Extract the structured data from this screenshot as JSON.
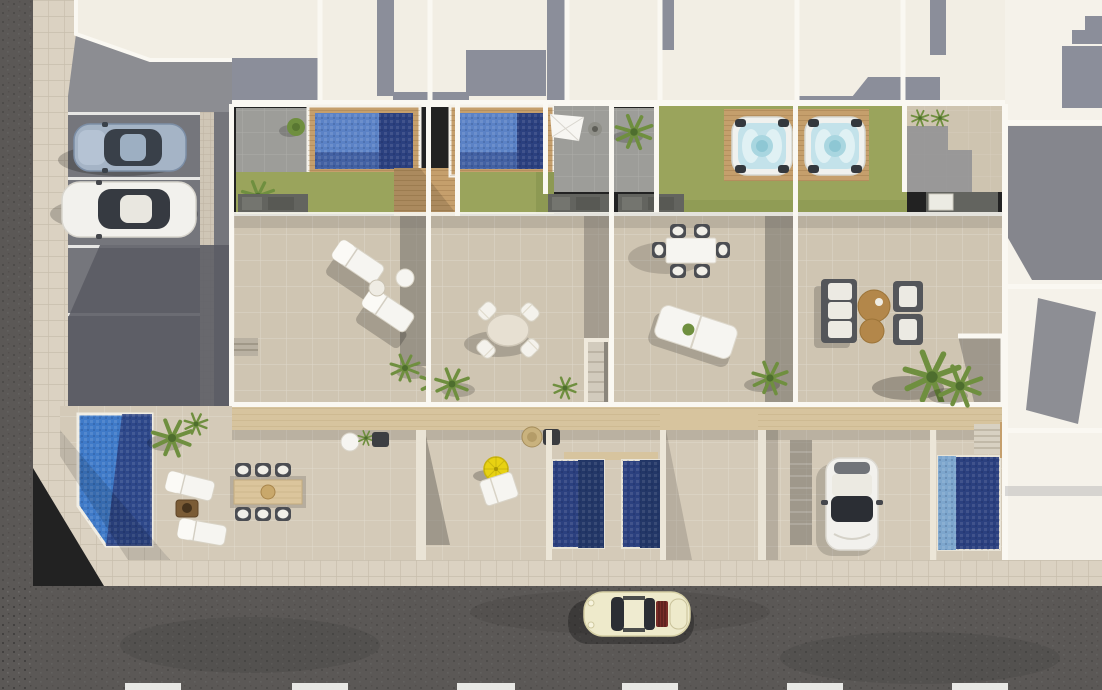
{
  "palette": {
    "asphalt": "#5b5856",
    "sidewalk-tile": "#dbd2c2",
    "tile-grout": "#c8bead",
    "parking": "#75767c",
    "parking-shadow": "#5a5b63",
    "roof-cream": "#f2eee4",
    "roof-gray": "#8b8e9a",
    "wall-white": "#faf8f2",
    "gray-terrace": "#9d9d99",
    "terrace": "#cfc5b2",
    "terrace-lower": "#d4cab8",
    "lawn": "#9aa45c",
    "lawn-dark": "#86934d",
    "pool-blue": "#5b82c6",
    "pool-navy": "#2b407f",
    "pool-bright": "#3f7ac8",
    "pool-light": "#7da6cd",
    "tub-rim": "#f0f1ee",
    "tub-water": "#c3e2ea",
    "wood": "#c59f6c",
    "wood-light": "#d7c49e",
    "wood-table": "#dbc59c",
    "furn-white": "#f6f5f1",
    "furn-dark": "#54565a",
    "tan": "#b3874a",
    "parasol-yellow": "#e8d212",
    "car-cream": "#eeeacb",
    "car-blue": "#a5b4c6",
    "car-white": "#f2f1ed",
    "glass": "#2b2e34",
    "maroon": "#7a2d28",
    "plant": "#6f8f3f",
    "line-white": "#f4f4f1"
  },
  "scene": {
    "view": "aerial-top-down-render",
    "ground": [
      "asphalt-street-bottom",
      "asphalt-lane-left",
      "tiled-sidewalk-corner",
      "parking-lot",
      "tiled-plaza"
    ],
    "vehicles": [
      {
        "name": "parked-car-silver-blue",
        "location": "parking-stall-1"
      },
      {
        "name": "parked-car-white",
        "location": "parking-stall-2"
      },
      {
        "name": "driveway-car-white",
        "location": "lower-driveway"
      },
      {
        "name": "street-car-cream",
        "location": "street"
      }
    ],
    "amenities": [
      {
        "name": "rooftop-pool",
        "count": 2
      },
      {
        "name": "hot-tub-on-deck",
        "count": 2
      },
      {
        "name": "ground-level-pool",
        "count": 4
      },
      {
        "name": "lawn",
        "count": 4
      },
      {
        "name": "sun-lounger",
        "count": 7
      },
      {
        "name": "round-dining-set",
        "count": 1
      },
      {
        "name": "rect-dining-set",
        "count": 2
      },
      {
        "name": "lounge-sofa-set",
        "count": 1
      },
      {
        "name": "shade-sail",
        "count": 1
      },
      {
        "name": "yellow-parasol",
        "count": 1
      },
      {
        "name": "outdoor-kitchen-unit",
        "count": 4
      },
      {
        "name": "staircase",
        "count": 4
      },
      {
        "name": "palm-plant",
        "count": 12
      }
    ],
    "road_markings": {
      "lane_dashes": 6,
      "parking_stall_lines": 4
    }
  }
}
